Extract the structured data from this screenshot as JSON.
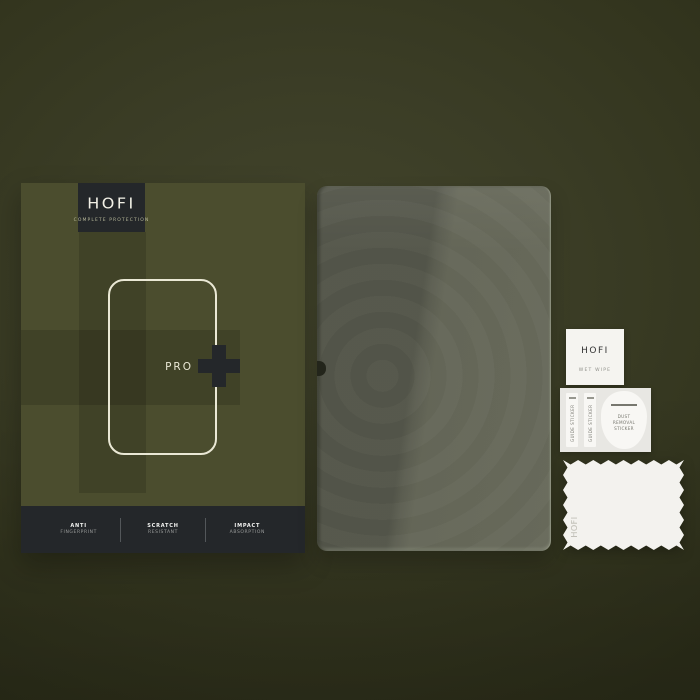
{
  "colors": {
    "bg-center": "#43452c",
    "bg-edge": "#2d2f1a",
    "box-olive": "#4b4d2e",
    "box-shade": "rgba(0,0,0,0.14)",
    "panel-dark": "#24272a",
    "cream": "#eae8d5",
    "tagline-olive": "#b9ba9b",
    "glass-dark": "#54564a",
    "glass-light": "#666859",
    "paper-white": "#f5f4f0",
    "sheet-gray": "#e8e7e3",
    "ink-dark": "#333333",
    "ink-soft": "#77776f"
  },
  "box": {
    "brand": "HOFI",
    "tagline": "COMPLETE PROTECTION",
    "model_label": "PRO",
    "features": [
      {
        "top": "ANTI",
        "bottom": "FINGERPRINT"
      },
      {
        "top": "SCRATCH",
        "bottom": "RESISTANT"
      },
      {
        "top": "IMPACT",
        "bottom": "ABSORPTION"
      }
    ]
  },
  "accessories": {
    "wet_wipe": {
      "brand": "HOFI",
      "label": "WET WIPE"
    },
    "sticker_sheet": {
      "guide_sticker_1": "GUIDE STICKER",
      "guide_sticker_2": "GUIDE STICKER",
      "dust_removal": "DUST REMOVAL STICKER"
    },
    "cloth": {
      "brand": "HOFI"
    }
  }
}
